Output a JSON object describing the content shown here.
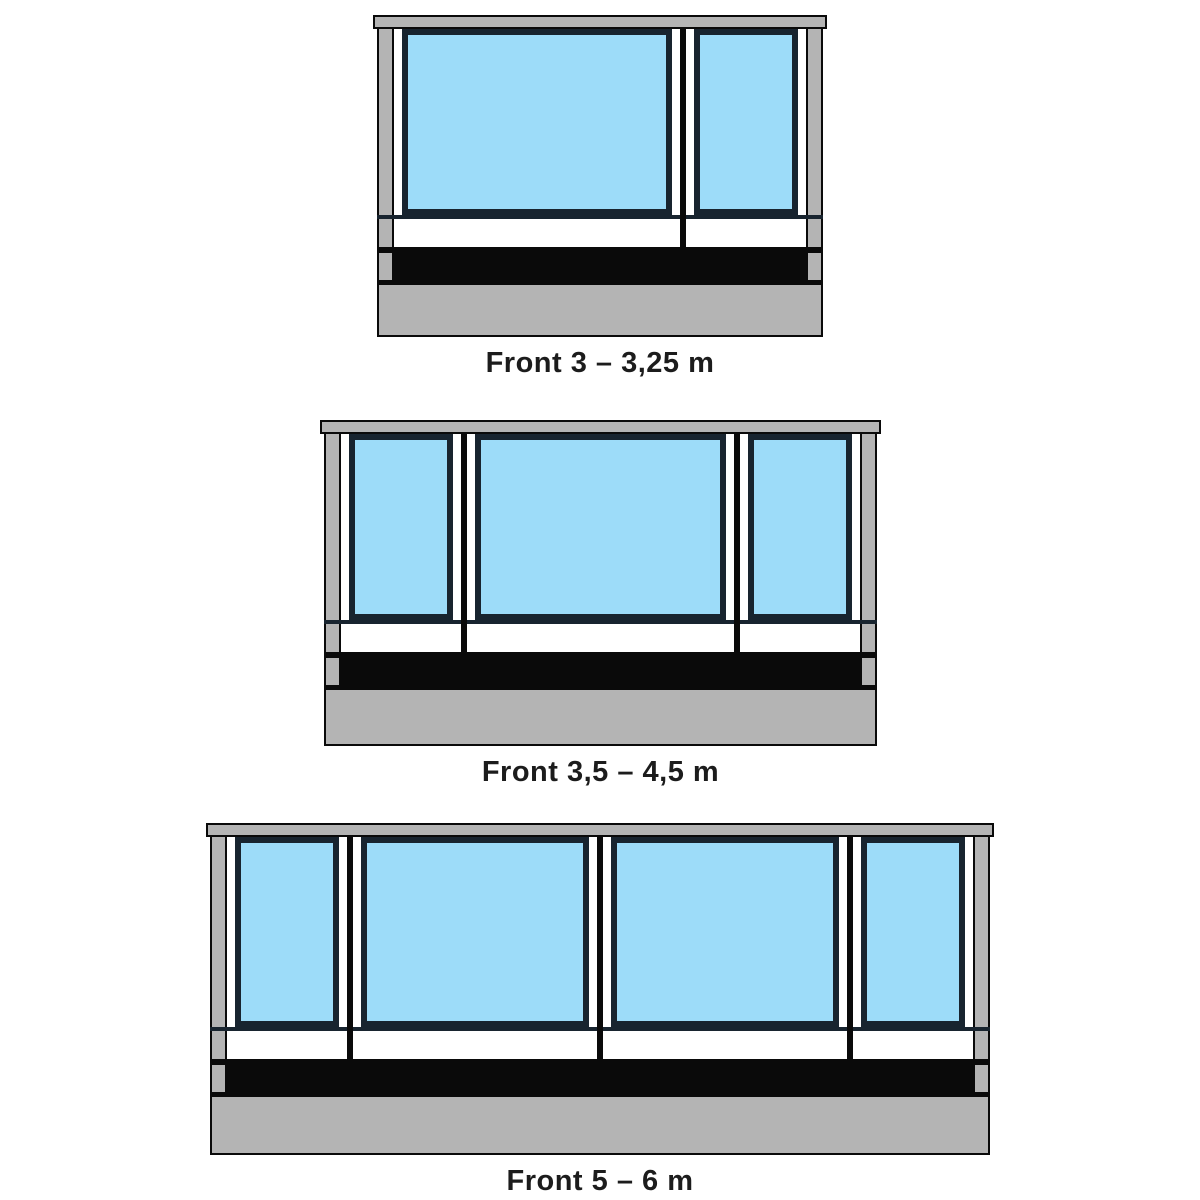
{
  "page": {
    "background": "#ffffff"
  },
  "colors": {
    "frame_gray": "#b4b4b4",
    "window_blue": "#9ddcf9",
    "window_frame": "#18242f",
    "line_black": "#0a0a0a",
    "band_white": "#ffffff",
    "label_text": "#1c1c1c"
  },
  "diagrams": [
    {
      "label": "Front 3 – 3,25 m",
      "windows": [
        "large",
        "small"
      ]
    },
    {
      "label": "Front 3,5 – 4,5 m",
      "windows": [
        "small",
        "large",
        "small"
      ]
    },
    {
      "label": "Front 5 – 6 m",
      "windows": [
        "small",
        "large",
        "large",
        "small"
      ]
    }
  ]
}
